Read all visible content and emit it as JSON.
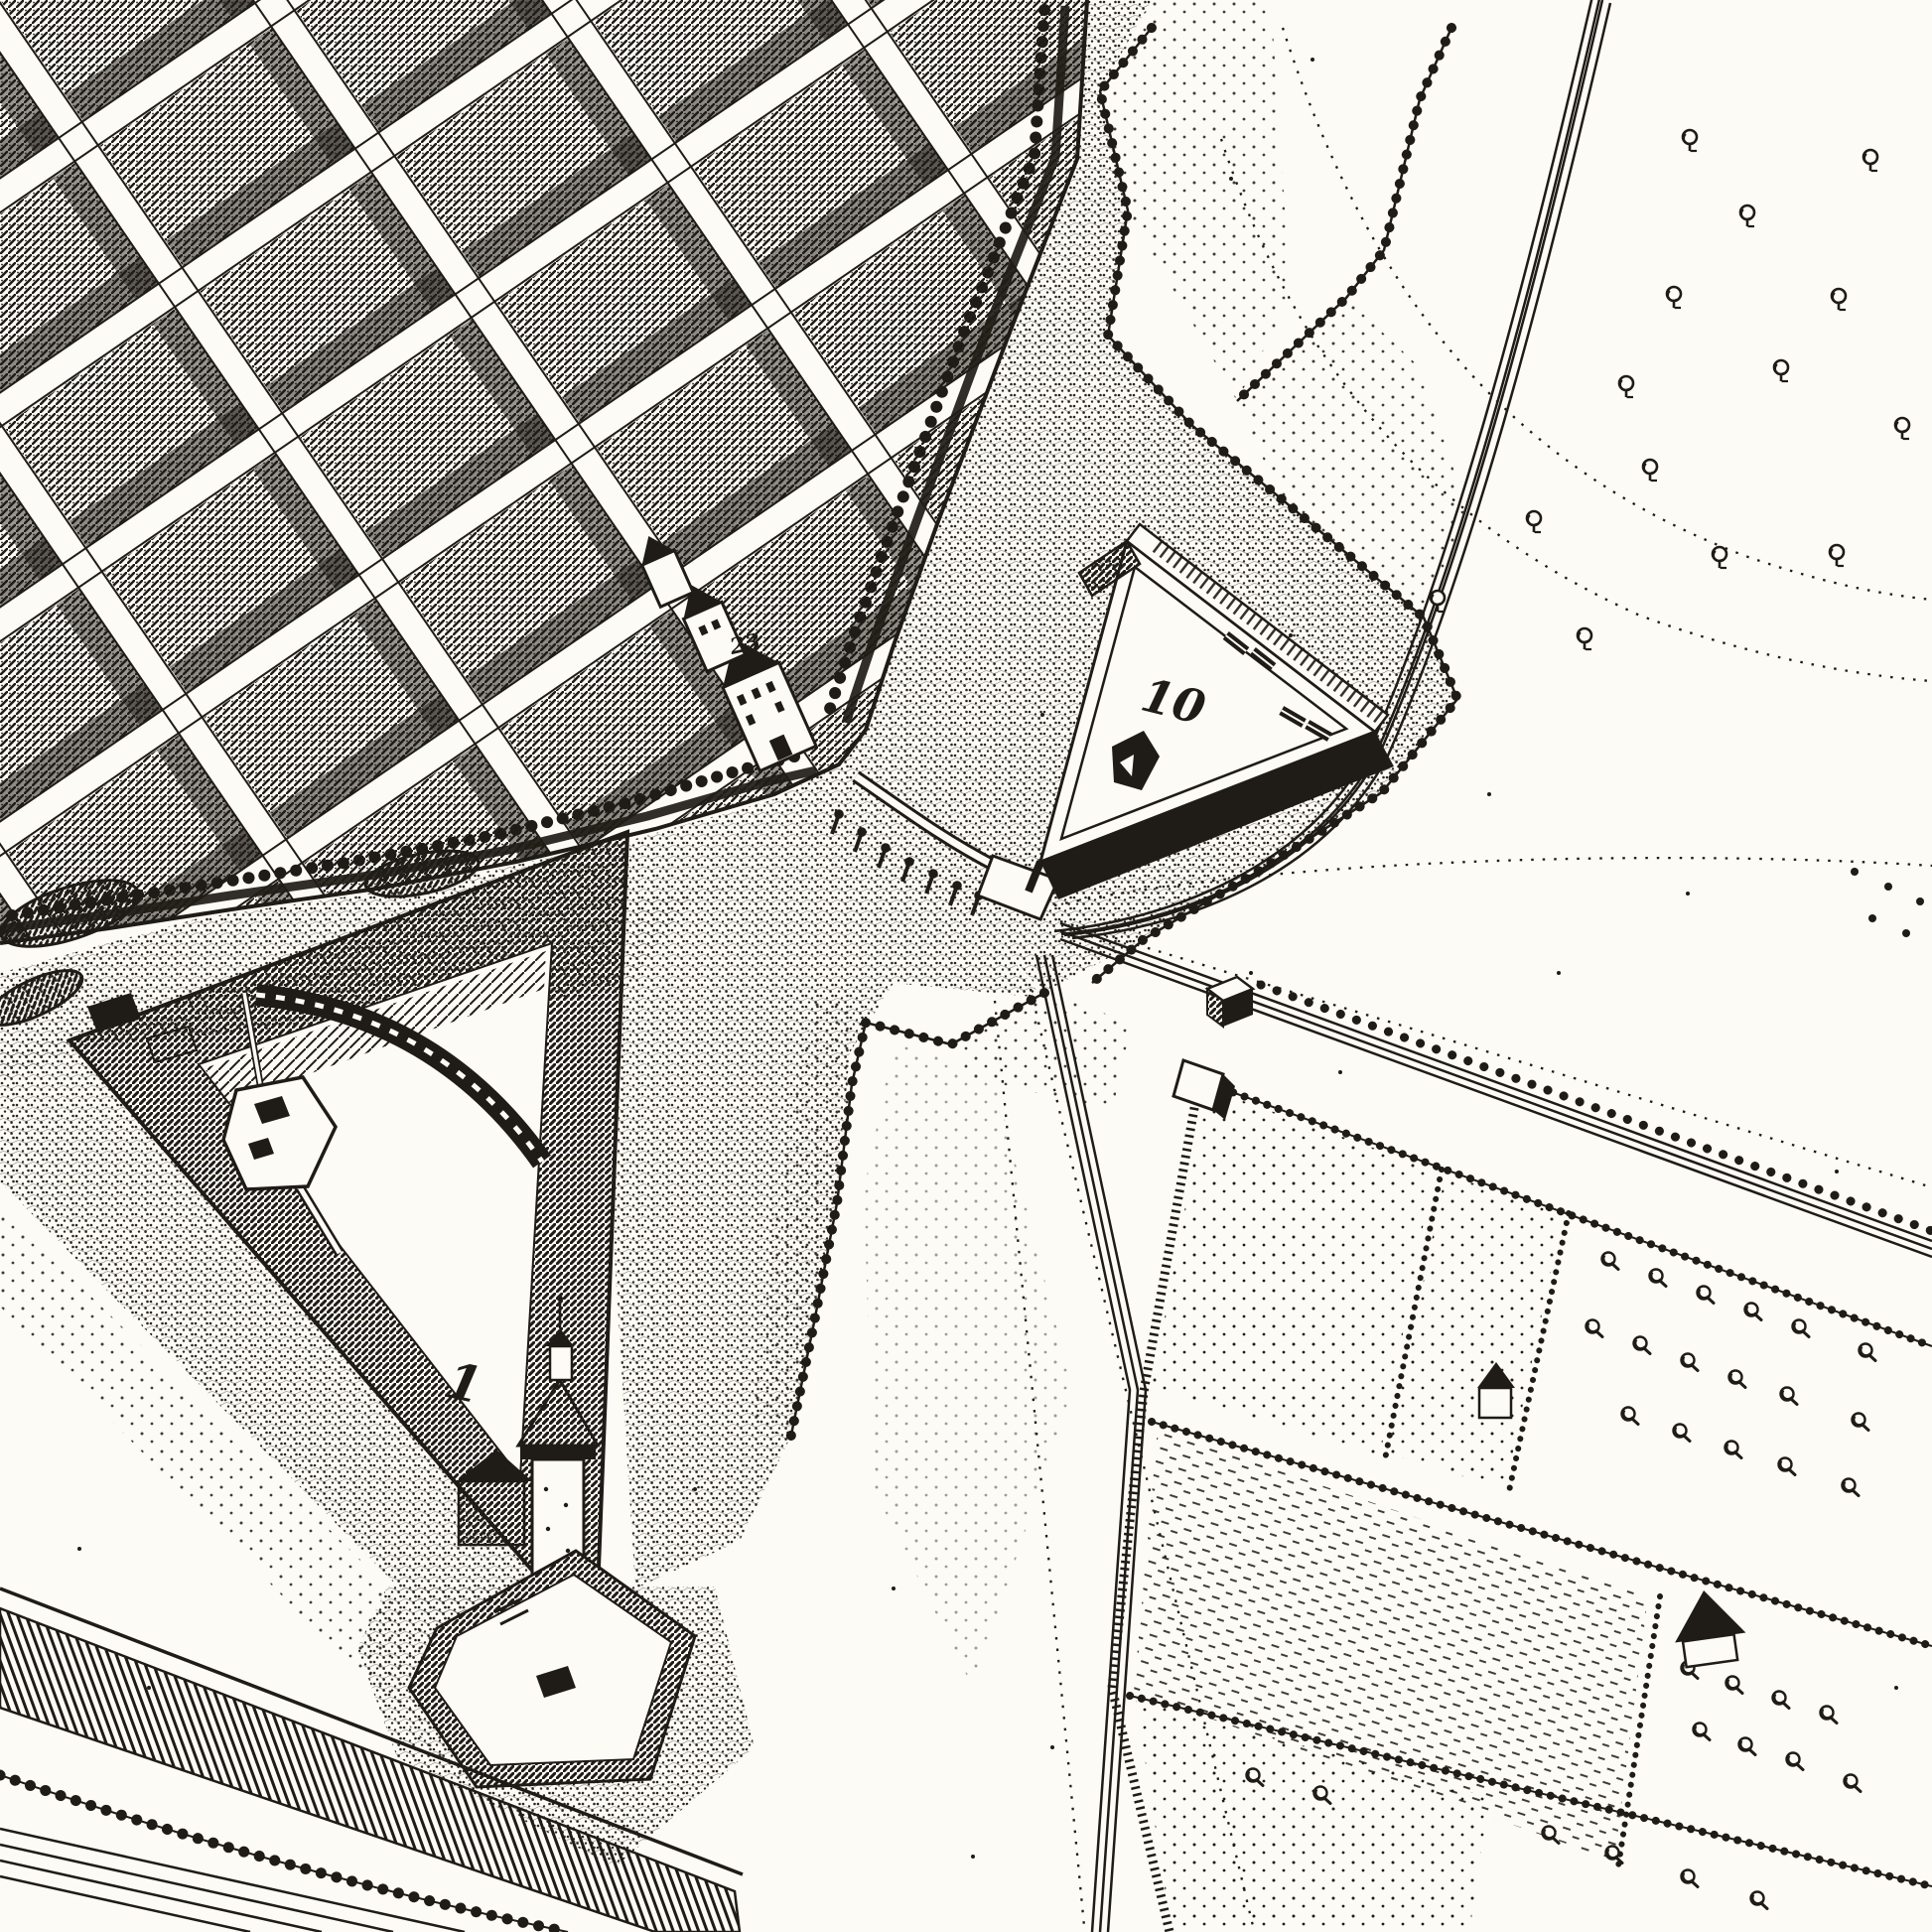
{
  "palette": {
    "ink": "#1f1b16",
    "paper": "#fcfbf6"
  },
  "labels": {
    "ravelin_number": "10",
    "fort_number": "1",
    "street_number": "23"
  }
}
